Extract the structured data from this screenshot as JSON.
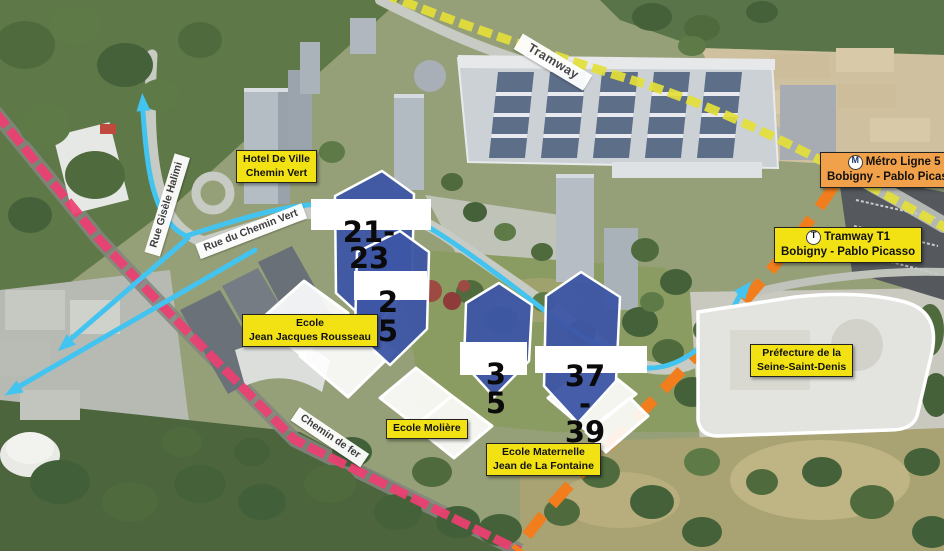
{
  "colors": {
    "tramway_line_yellow": "#e4de3a",
    "metro_line_orange": "#f17d1d",
    "railway_pink": "#ee3f72",
    "route_cyan": "#43c4f0",
    "highlighted_building_blue": "#3e56a6",
    "label_yellow": "#f2e214",
    "label_orange": "#f2a14b"
  },
  "transit": {
    "metro": {
      "icon": "M",
      "line1": "Métro Ligne 5",
      "line2": "Bobigny - Pablo Picasso"
    },
    "tram": {
      "icon": "T",
      "line1": "Tramway T1",
      "line2": "Bobigny - Pablo Picasso"
    },
    "tram_track_label": "Tramway"
  },
  "places": {
    "hotel_de_ville": {
      "line1": "Hotel De Ville",
      "line2": "Chemin Vert"
    },
    "ecole_rousseau": {
      "line1": "Ecole",
      "line2": "Jean Jacques Rousseau"
    },
    "ecole_moliere": {
      "line1": "Ecole Molière"
    },
    "ecole_maternelle": {
      "line1": "Ecole Maternelle",
      "line2": "Jean de La Fontaine"
    },
    "prefecture": {
      "line1": "Préfecture de la",
      "line2": "Seine-Saint-Denis"
    }
  },
  "streets": {
    "rue_gisele_halimi": "Rue Gisèle Halimi",
    "rue_du_chemin_vert": "Rue du Chemin Vert",
    "chemin_de_fer": "Chemin de fer"
  },
  "building_numbers": [
    {
      "id": "21-23",
      "lines": [
        "21-",
        "23"
      ]
    },
    {
      "id": "25",
      "lines": [
        "2",
        "5"
      ]
    },
    {
      "id": "35",
      "lines": [
        "3",
        "5"
      ]
    },
    {
      "id": "37-39",
      "lines": [
        "37",
        "-",
        "39"
      ]
    }
  ]
}
